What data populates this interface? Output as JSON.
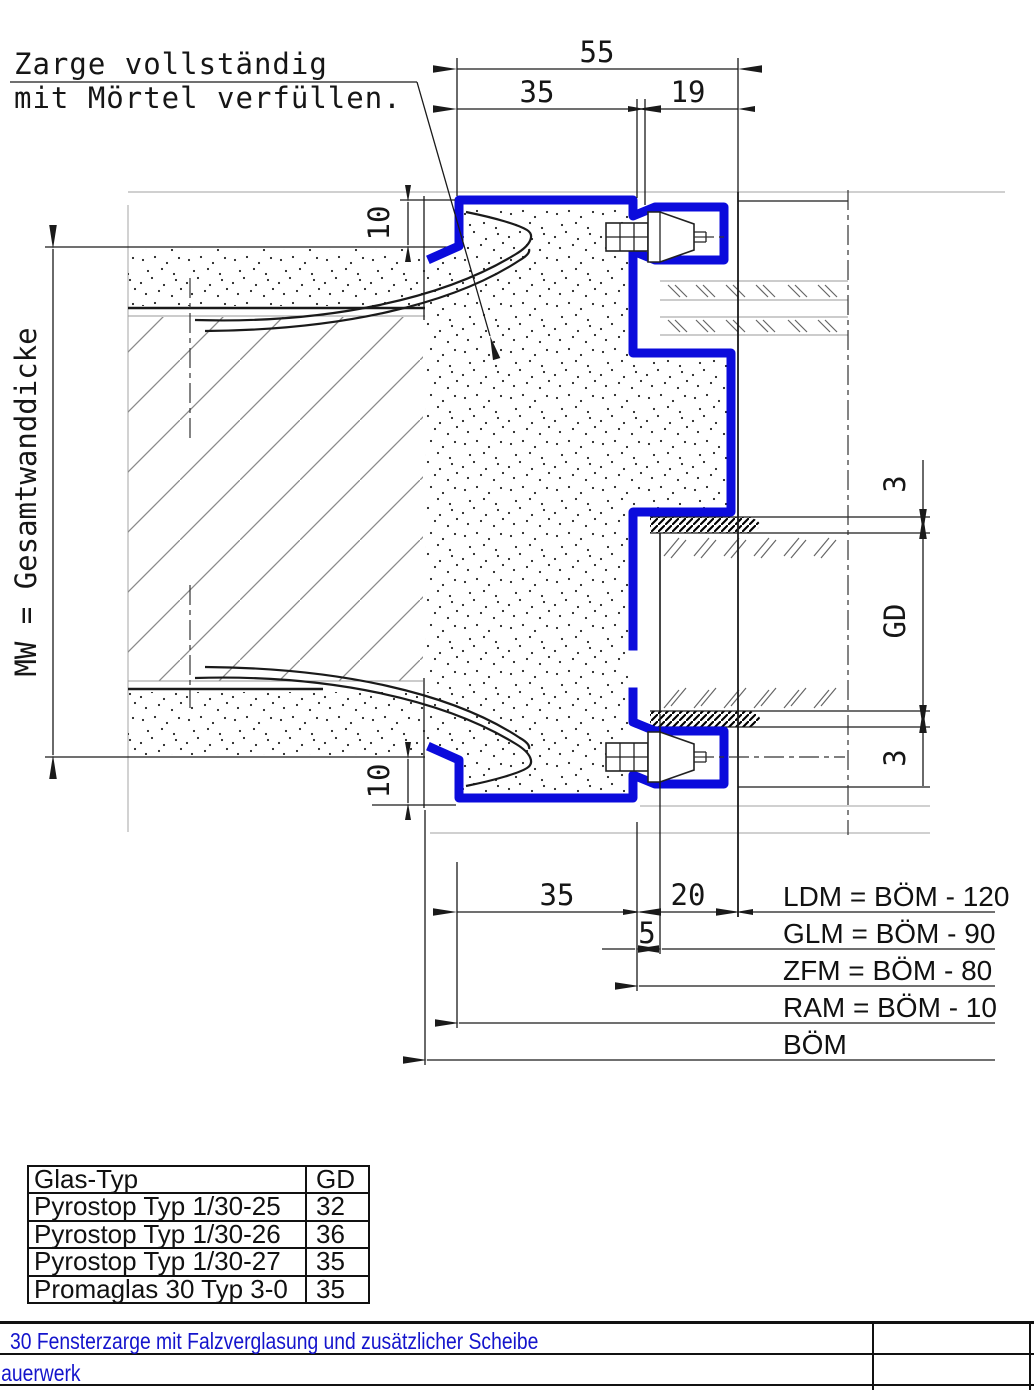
{
  "drawing": {
    "annotation": {
      "line1": "Zarge vollständig",
      "line2": "mit Mörtel verfüllen."
    },
    "wall_dim_label": "MW = Gesamtwanddicke",
    "dims": {
      "total_width": "55",
      "frame_depth_top": "35",
      "rebate_width_top": "19",
      "top_offset": "10",
      "bottom_offset": "10",
      "seal_top": "3",
      "glass_thickness": "GD",
      "seal_bottom": "3",
      "frame_depth_bottom": "35",
      "rebate_width_bottom": "20",
      "gap": "5"
    },
    "formulas": {
      "ldm": "LDM = BÖM - 120",
      "glm": "GLM = BÖM - 90",
      "zfm": "ZFM = BÖM - 80",
      "ram": "RAM = BÖM - 10",
      "boem": "BÖM"
    }
  },
  "glass_table": {
    "headers": [
      "Glas-Typ",
      "GD"
    ],
    "rows": [
      [
        "Pyrostop Typ 1/30-25",
        "32"
      ],
      [
        "Pyrostop Typ 1/30-26",
        "36"
      ],
      [
        "Pyrostop Typ 1/30-27",
        "35"
      ],
      [
        "Promaglas 30 Typ 3-0",
        "35"
      ]
    ]
  },
  "title_block": {
    "line1": "30 Fensterzarge mit Falzverglasung und zusätzlicher Scheibe",
    "line2": "Mauerwerk"
  },
  "colors": {
    "frame_blue": "#0b0bdc",
    "title_text_blue": "#1414cc",
    "line_dark": "#1a1a1a",
    "line_gray": "#b5b5b5"
  }
}
